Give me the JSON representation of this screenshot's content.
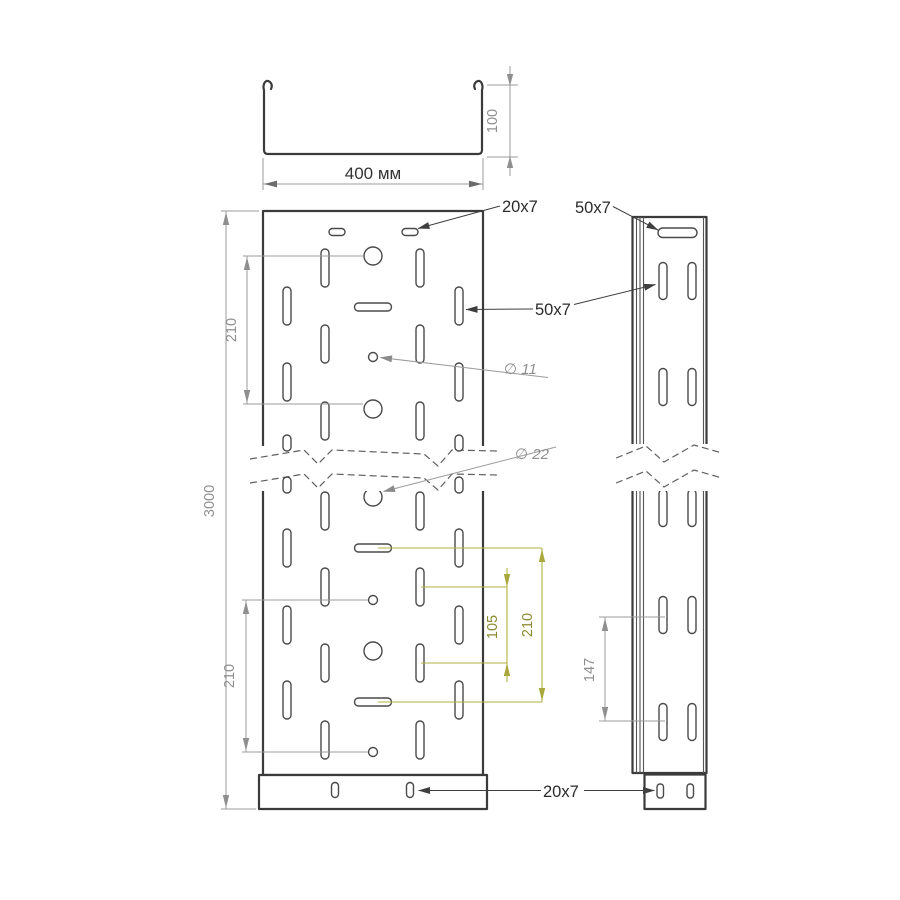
{
  "section_view": {
    "width_label": "400 мм",
    "height_label": "100"
  },
  "front_view": {
    "length_label": "3000",
    "top_pitch_label": "210",
    "bottom_pitch_label": "210",
    "top_slot_label": "20x7",
    "wall_slot_label": "50x7",
    "small_hole_label": "∅ 11",
    "large_hole_label": "∅ 22",
    "slot_pitch_label": "105",
    "row_pitch_label": "210",
    "flange_slot_label": "20x7"
  },
  "side_view": {
    "top_slot_label": "50x7",
    "slot_pitch_label": "147"
  },
  "colors": {
    "outline": "#3b3b3b",
    "dimension_gray": "#9b9b9b",
    "dimension_olive": "#b2b240",
    "label_dark": "#2b2b2b",
    "background": "#ffffff"
  }
}
